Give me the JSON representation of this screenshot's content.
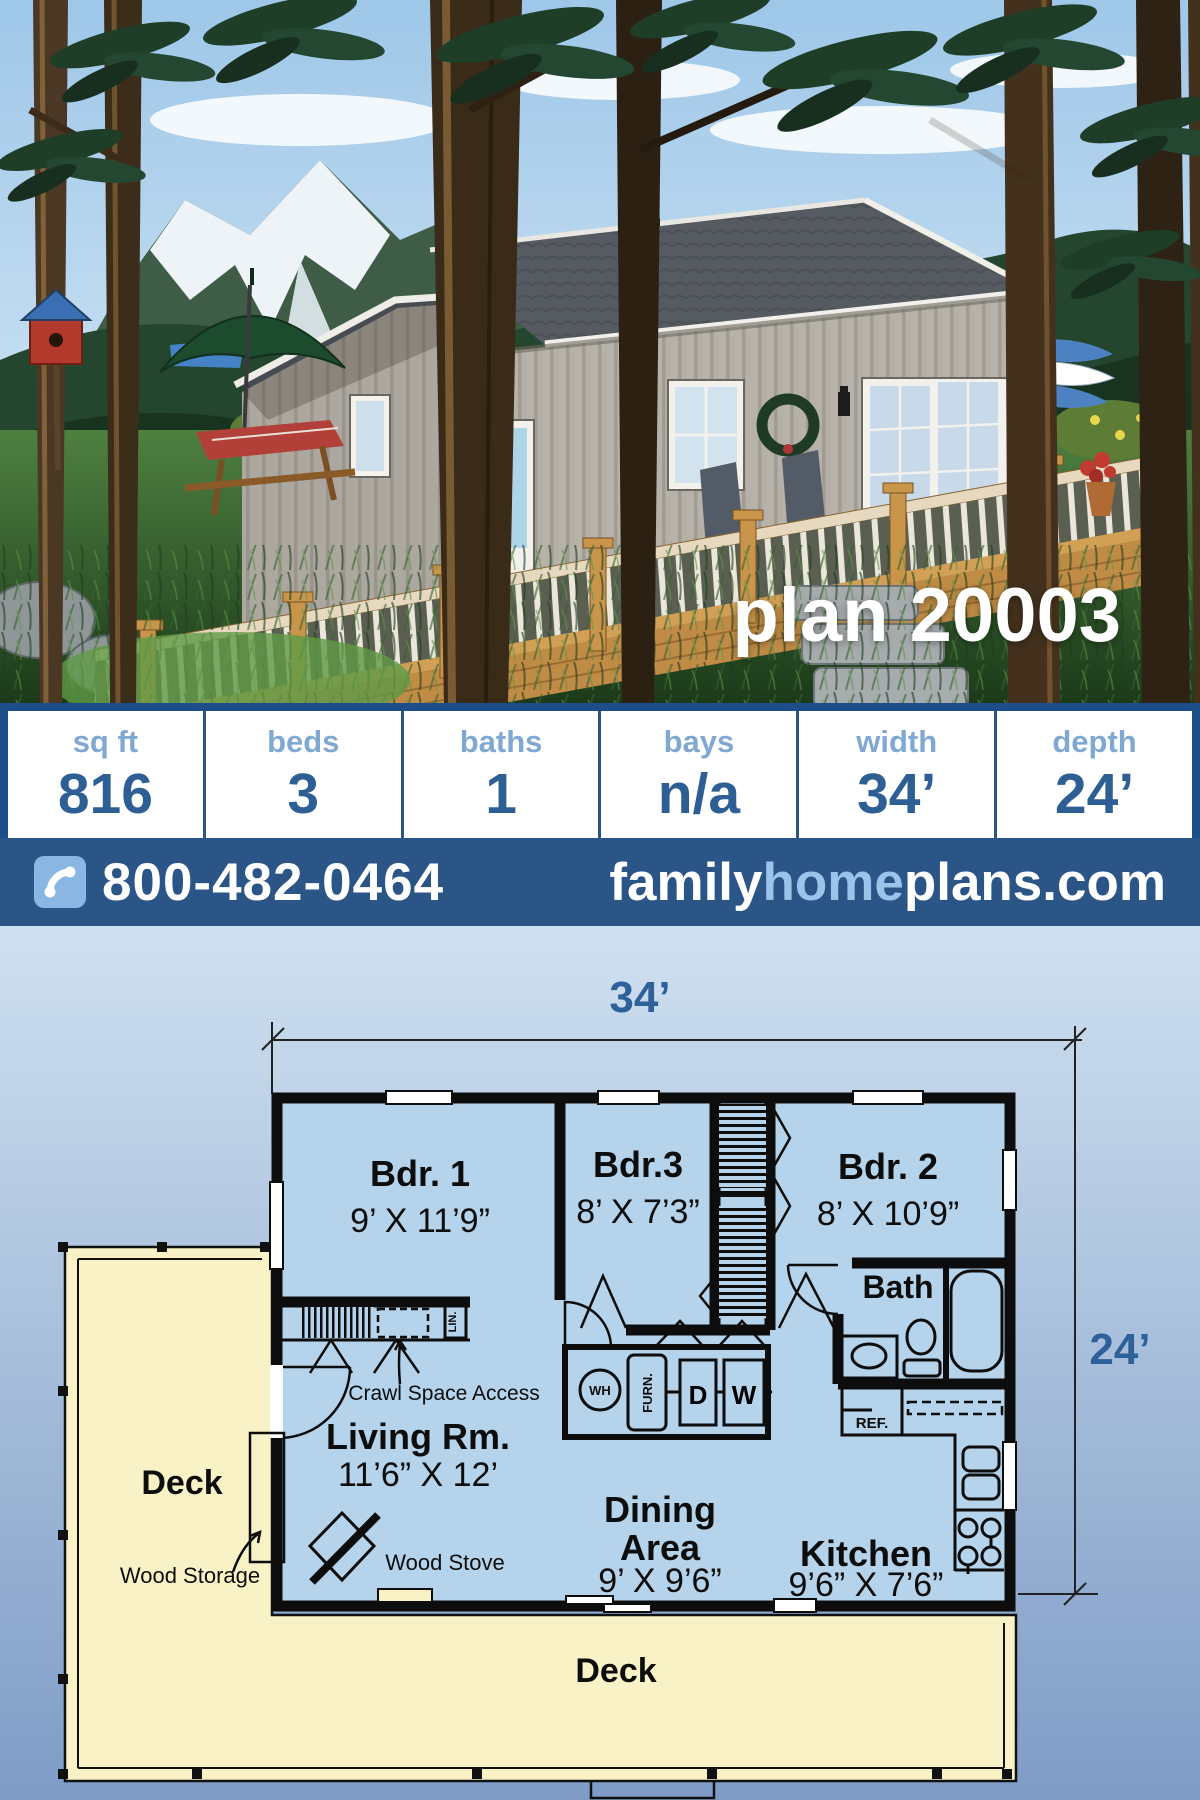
{
  "plan_title": "plan 20003",
  "stats": [
    {
      "label": "sq ft",
      "value": "816"
    },
    {
      "label": "beds",
      "value": "3"
    },
    {
      "label": "baths",
      "value": "1"
    },
    {
      "label": "bays",
      "value": "n/a"
    },
    {
      "label": "width",
      "value": "34’"
    },
    {
      "label": "depth",
      "value": "24’"
    }
  ],
  "contact": {
    "phone": "800-482-0464",
    "site_family": "family",
    "site_home": "home",
    "site_plans": "plans.com"
  },
  "floor_plan": {
    "width_dim": "34’",
    "depth_dim": "24’",
    "rooms": {
      "bdr1": {
        "name": "Bdr. 1",
        "size": "9’ X 11’9”"
      },
      "bdr3": {
        "name": "Bdr.3",
        "size": "8’ X 7’3”"
      },
      "bdr2": {
        "name": "Bdr. 2",
        "size": "8’ X 10’9”"
      },
      "bath": {
        "name": "Bath"
      },
      "living": {
        "name": "Living Rm.",
        "size": "11’6” X 12’"
      },
      "dining": {
        "name_line1": "Dining",
        "name_line2": "Area",
        "size": "9’ X 9’6”"
      },
      "kitchen": {
        "name": "Kitchen",
        "size": "9’6” X 7’6”"
      },
      "deck_left": {
        "name": "Deck"
      },
      "deck_bottom": {
        "name": "Deck"
      }
    },
    "labels": {
      "crawl_space": "Crawl Space Access",
      "wood_storage": "Wood Storage",
      "wood_stove": "Wood Stove",
      "lin": "LIN.",
      "wh": "WH",
      "furn": "FURN.",
      "d": "D",
      "w": "W",
      "ref": "REF."
    }
  },
  "colors": {
    "border_blue": "#1d4e8c",
    "bar_blue": "#2b5587",
    "stat_label_blue": "#7fa8d2",
    "stat_value_blue": "#2d5f95",
    "website_home_blue": "#9cc4ea",
    "room_fill": "#b5d3ea",
    "deck_fill": "#f8f2c6",
    "dim_text_blue": "#2e609a"
  }
}
